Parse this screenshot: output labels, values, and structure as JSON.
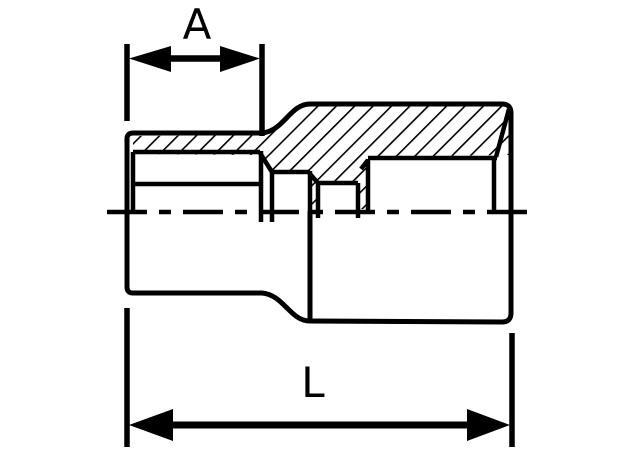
{
  "diagram": {
    "type": "engineering-drawing",
    "view": "half-section",
    "subject": "socket cross-section",
    "labels": {
      "width_dimension": "A",
      "length_dimension": "L"
    },
    "colors": {
      "ink": "#000000",
      "paper": "#ffffff"
    }
  }
}
